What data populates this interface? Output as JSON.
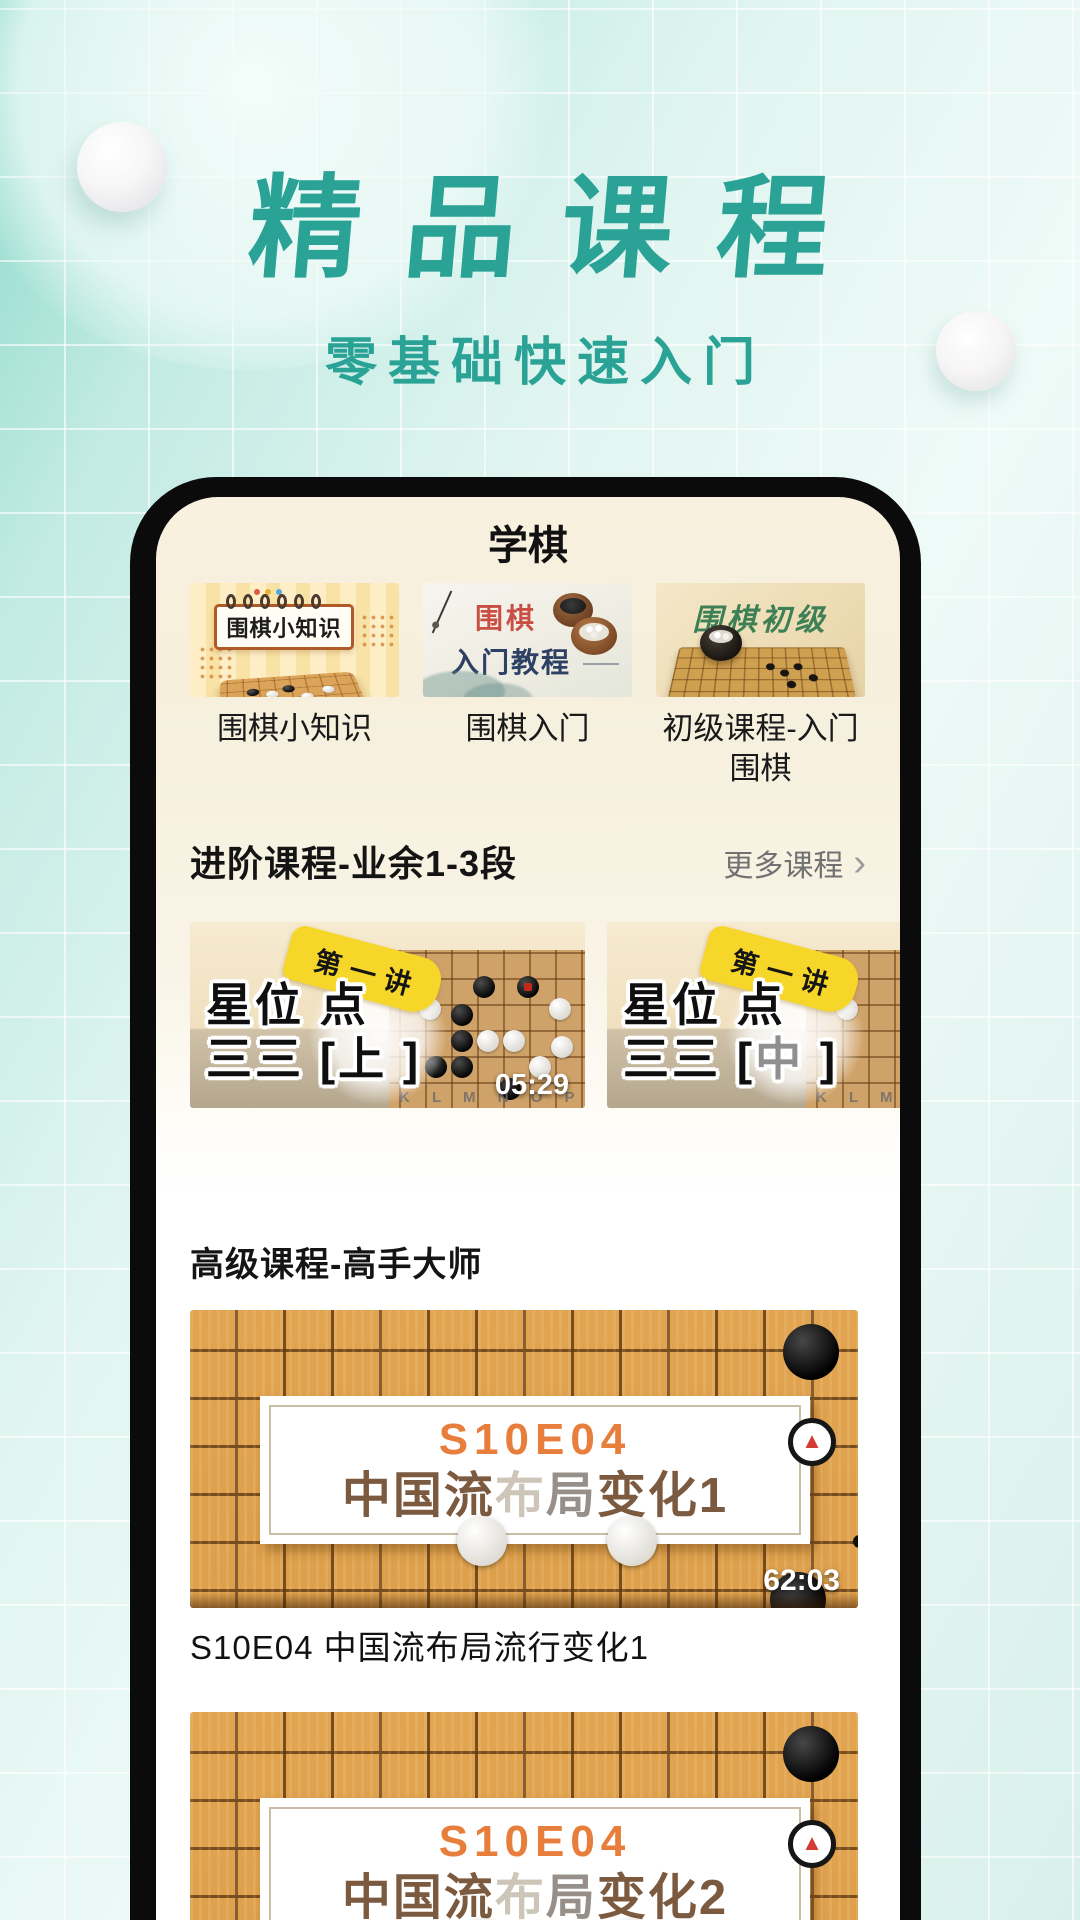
{
  "colors": {
    "accent_teal": "#2aa396",
    "board_orange": "#e2a44e",
    "badge_yellow": "#f7d62a",
    "code_orange": "#e87e3b",
    "title_red": "#c94f45",
    "title_navy": "#2e4064",
    "title_green": "#3e8055"
  },
  "hero": {
    "title": "精品课程",
    "subtitle": "零基础快速入门"
  },
  "app": {
    "nav_title": "学棋",
    "quick_courses": [
      {
        "card_title": "围棋小知识",
        "label": "围棋小知识"
      },
      {
        "card_title": "围棋",
        "card_subtitle": "入门教程",
        "label": "围棋入门"
      },
      {
        "card_title": "围棋初级",
        "label": "初级课程-入门围棋"
      }
    ],
    "intermediate": {
      "title": "进阶课程-业余1-3段",
      "more_label": "更多课程",
      "more_chevron": "›",
      "videos": [
        {
          "badge": "第一讲",
          "headline_line1": "星位 点",
          "line2_prefix": "三三 [",
          "line2_accent": "上",
          "line2_suffix": " ]",
          "board_letters": "K L M N O P",
          "duration": "05:29"
        },
        {
          "badge": "第一讲",
          "headline_line1": "星位 点",
          "line2_prefix": "三三 [",
          "line2_accent": "中",
          "line2_suffix": " ]",
          "board_letters": "K L M N",
          "duration": ""
        }
      ]
    },
    "advanced": {
      "title": "高级课程-高手大师",
      "videos": [
        {
          "code": "S10E04",
          "title_seg_dark1": "中国流",
          "title_seg_light": "布",
          "title_seg_mid": "局",
          "title_seg_dark2": "变化1",
          "duration": "62:03",
          "caption": "S10E04 中国流布局流行变化1"
        },
        {
          "code": "S10E04",
          "title_seg_dark1": "中国流",
          "title_seg_light": "布",
          "title_seg_mid": "局",
          "title_seg_dark2": "变化2",
          "duration": "",
          "caption": ""
        }
      ]
    }
  }
}
